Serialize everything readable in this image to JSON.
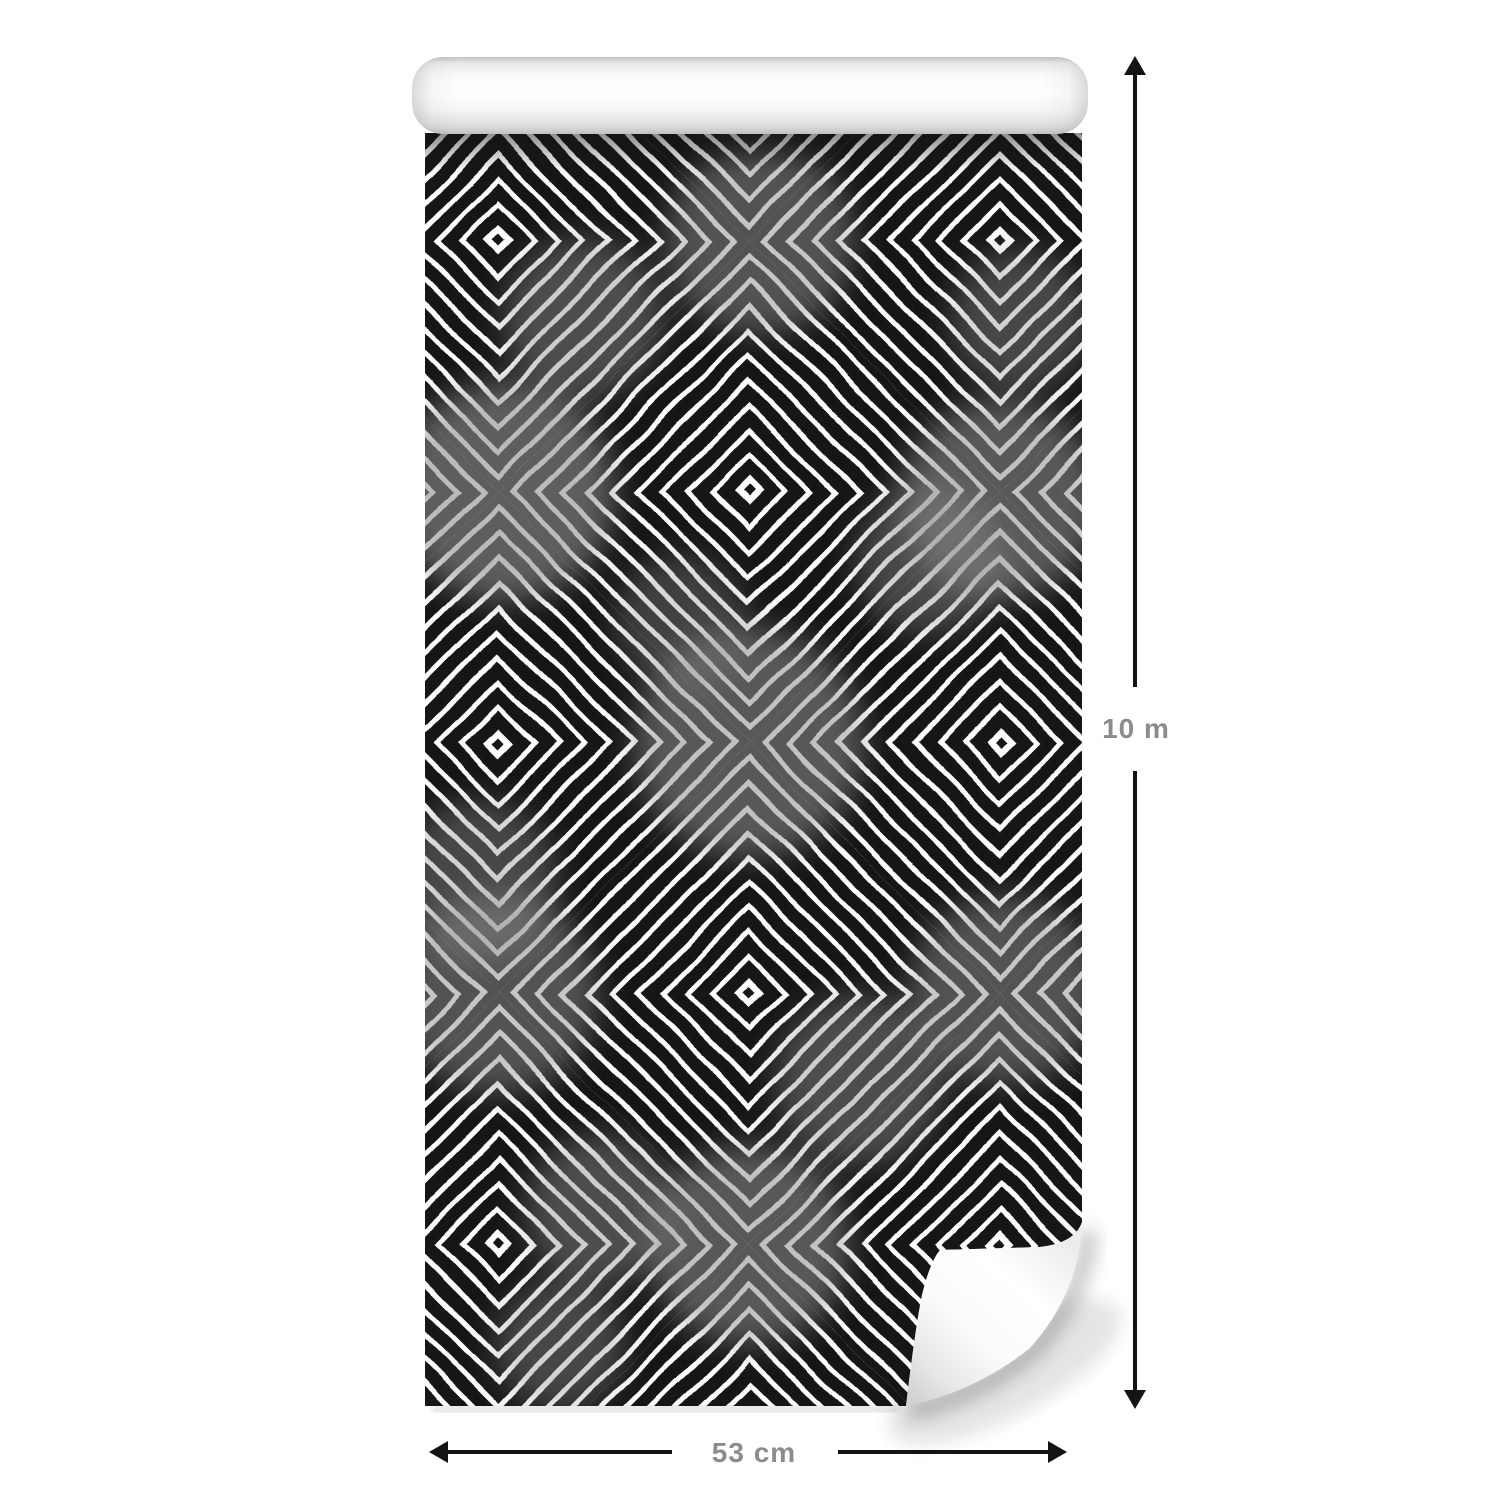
{
  "product": {
    "description": "Rolled wallpaper strip with hand-painted black and white concentric diamond geometric pattern; white rolled cylinder at top and curled page corner at bottom right"
  },
  "annotations": {
    "height": {
      "label": "10 m"
    },
    "width": {
      "label": "53 cm"
    }
  },
  "colors": {
    "background": "#ffffff",
    "pattern_black": "#181818",
    "pattern_white": "#fdfdfd",
    "watercolor_gray": "#909090",
    "arrow": "#141414",
    "label": "#8c8c8c"
  }
}
